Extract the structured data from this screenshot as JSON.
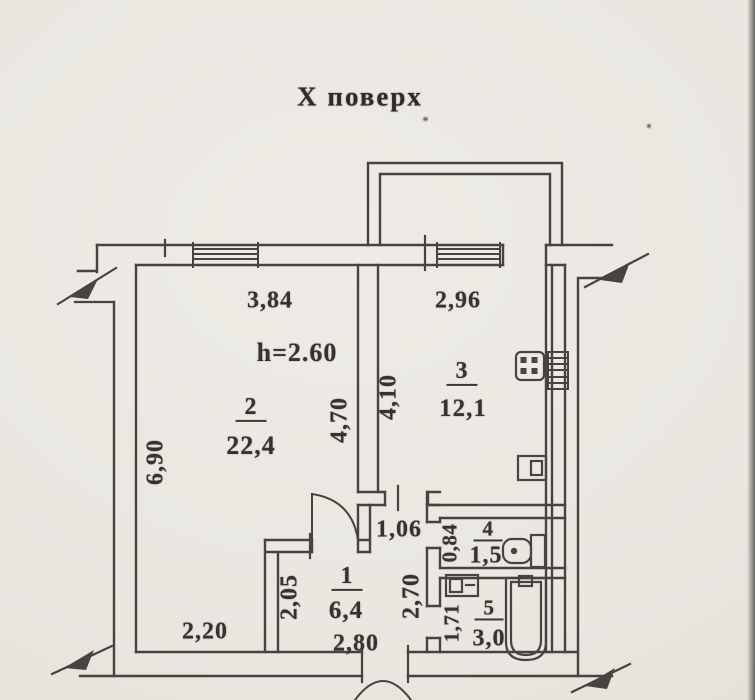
{
  "title": "Х поверх",
  "colors": {
    "paper": "#e9e6e0",
    "ink": "#474440",
    "text": "#36332e"
  },
  "rooms": [
    {
      "number": "2",
      "area": "22,4",
      "note": "h=2.60"
    },
    {
      "number": "3",
      "area": "12,1"
    },
    {
      "number": "1",
      "area": "6,4"
    },
    {
      "number": "4",
      "area": "1,5"
    },
    {
      "number": "5",
      "area": "3,0"
    }
  ],
  "dimensions": {
    "room2_width_top": "3,84",
    "room2_height_left": "6,90",
    "room2_height_right": "4,70",
    "room2_width_bottom": "2,20",
    "ceiling_height": "h=2.60",
    "kitchen_width_top": "2,96",
    "kitchen_height_left": "4,10",
    "hall_height_left": "2,05",
    "hall_width_bottom": "2,80",
    "hall_height_right": "2,70",
    "corridor_width": "1,06",
    "wc_height_left": "0,84",
    "bath_height_left": "1,71"
  },
  "fixtures": [
    "stove-icon",
    "ventilation-shaft-icon",
    "kitchen-sink-icon",
    "toilet-icon",
    "washbasin-icon",
    "bathtub-icon",
    "window-icon",
    "balcony-outline",
    "entrance-door-arc",
    "wall-break-icon"
  ]
}
